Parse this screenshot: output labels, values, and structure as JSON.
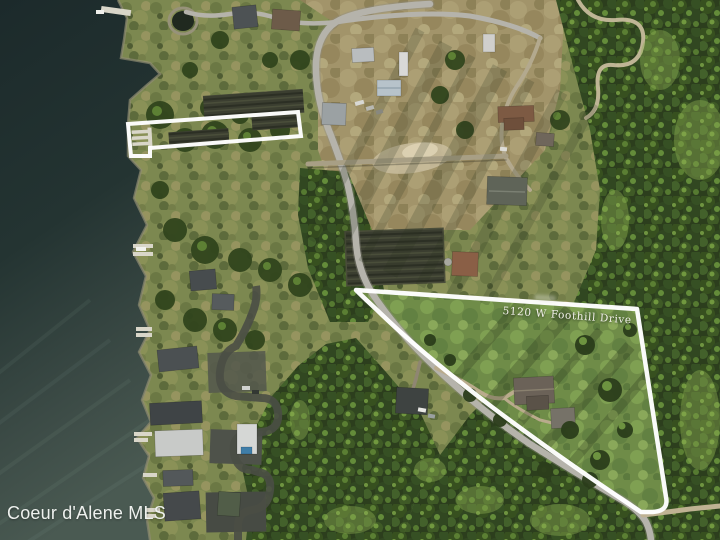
{
  "photo": {
    "description": "Aerial drone photo of lakefront acreage with outlined property parcels",
    "watermark": "Coeur d'Alene MLS",
    "parcels": {
      "main": {
        "label": "5120 W Foothill Drive"
      },
      "dock_strip": {
        "label": ""
      }
    },
    "colors": {
      "water_deep": "#1c2a2b",
      "water_light": "#4a5a52",
      "forest": "#2c3e1d",
      "forest_lit": "#90b155",
      "grass": "#6f8c48",
      "scrub": "#7c8850",
      "field_tan": "#a2946a",
      "road": "#b5b3ab",
      "dirt_road": "#c6bb9c",
      "asphalt": "#4a4e45",
      "boundary_line": "#ffffff",
      "label_text": "#f2f1ea"
    }
  }
}
